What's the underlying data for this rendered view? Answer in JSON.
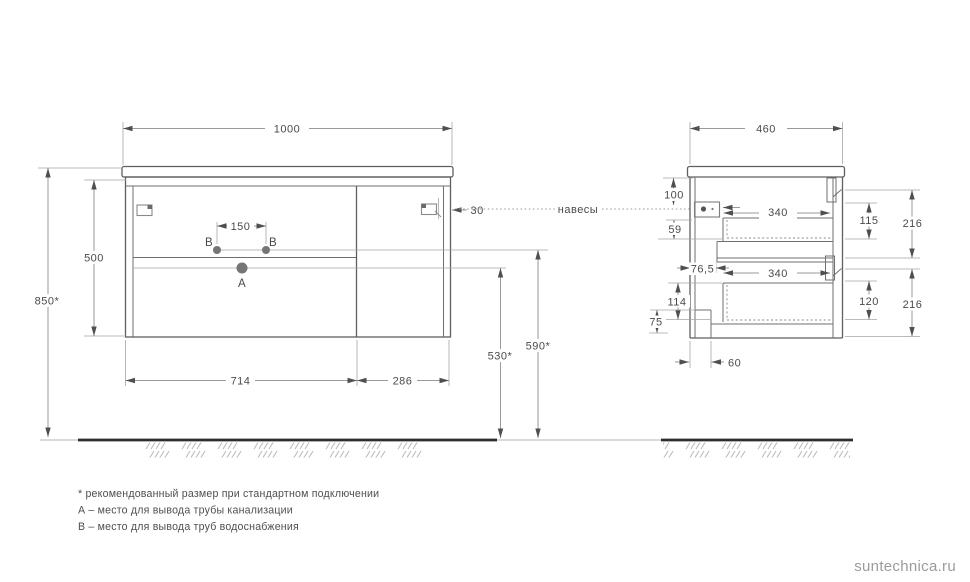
{
  "drawing": {
    "front_view": {
      "dim_width": "1000",
      "dim_overall_height": "850*",
      "dim_cabinet_height": "500",
      "dim_supply_spacing": "150",
      "dim_hanger_inset": "30",
      "dim_section_left": "714",
      "dim_section_right": "286",
      "dim_drain_outlet_height": "530*",
      "dim_supply_outlet_height": "590*",
      "label_point_a": "A",
      "label_point_b_left": "B",
      "label_point_b_right": "B"
    },
    "side_view": {
      "dim_depth": "460",
      "dim_top_to_hanger": "100",
      "dim_hanger_to_drawer": "59",
      "dim_back_offset": "76,5",
      "dim_drawer_depth_upper": "340",
      "dim_drawer_depth_lower": "340",
      "dim_drawer_inner_upper": "115",
      "dim_front_height_upper": "216",
      "dim_drawer_inner_lower": "120",
      "dim_front_height_lower": "216",
      "dim_back_bottom": "114",
      "dim_bottom_clearance": "75",
      "dim_toe_recess": "60"
    },
    "annotations": {
      "hangers": "навесы"
    }
  },
  "footnotes": {
    "asterisk": "* рекомендованный размер при стандартном подключении",
    "point_a": "А – место для вывода трубы канализации",
    "point_b": "В – место для вывода труб водоснабжения"
  },
  "watermark": "suntechnica.ru",
  "colors": {
    "outline": "#5f5f5f",
    "dim_line": "#9a9a9a",
    "dim_text": "#4a4a4a",
    "floor": "#2e2e2e",
    "hatch": "#b8b8b8",
    "watermark": "#9b9b9b"
  }
}
